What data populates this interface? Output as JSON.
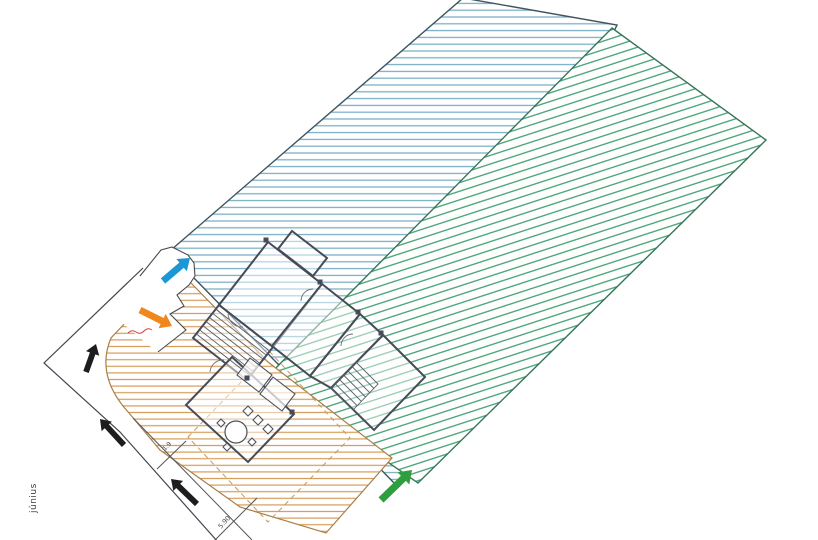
{
  "document": {
    "kind": "scanned architectural site / floor plan with colored zoning hatches",
    "background": "#ffffff"
  },
  "colors": {
    "blue_hatch": "#78aec6",
    "green_hatch": "#44a172",
    "orange_hatch": "#d59c58",
    "blue_edge": "#3e5560",
    "green_edge": "#35755a",
    "orange_edge": "#a97f47",
    "boundary_line": "#4a4a4a",
    "wall_line": "#454b57",
    "blue_arrow": "#1b97d6",
    "orange_arrow": "#f0861c",
    "green_arrow": "#2f9e3f",
    "black_arrow": "#1d1d1d",
    "red_mark": "#d04038"
  },
  "regions": {
    "blue_zone": {
      "points": "171,250 463,-2 617,25 398,487 194,278",
      "hatch": "horizontal"
    },
    "green_zone": {
      "points": "612,28 766,140 418,483 266,378",
      "hatch": "diagonal-up-right"
    },
    "orange_zone": {
      "path": "M191,283 L268,362 L392,458 L326,533 L240,507 L160,450 L129,413 Q95,376 111,338 L163,283 Z",
      "hatch": "horizontal"
    },
    "white_notch": {
      "points": "140,277 160,251 171,247 188,255 194,263 195,277 189,286 177,295 184,306 170,314 186,330 158,353 112,314"
    }
  },
  "lines": {
    "outer_site_boundary": "143,268 44,363 120,432 218,542",
    "notch_outline": "140,276 161,250 172,247 188,255 194,263 195,276 189,285 177,295 184,306 170,314 186,330 158,352",
    "curb_line": "M133,418 L252,540",
    "tick_small": "M157,469 L186,441",
    "tick_large": "M214,541 L257,498",
    "roof_overhang_dashed": "M188,437 L270,352 L350,438 L268,522 Z"
  },
  "annotations": {
    "margin_label": "június",
    "dim_small": "1.9",
    "dim_large": "5.90"
  },
  "arrows": [
    {
      "name": "blue-arrow",
      "x1": 163,
      "y1": 281,
      "x2": 190,
      "y2": 258,
      "color": "#1b97d6",
      "shaft": 3.4,
      "headL": 11,
      "headW": 8
    },
    {
      "name": "orange-arrow",
      "x1": 140,
      "y1": 310,
      "x2": 172,
      "y2": 326,
      "color": "#f0861c",
      "shaft": 3.4,
      "headL": 11,
      "headW": 8
    },
    {
      "name": "black-arrow-1",
      "x1": 86,
      "y1": 372,
      "x2": 96,
      "y2": 344,
      "color": "#1d1d1d",
      "shaft": 2.9,
      "headL": 10,
      "headW": 7
    },
    {
      "name": "black-arrow-2",
      "x1": 124,
      "y1": 445,
      "x2": 100,
      "y2": 419,
      "color": "#1d1d1d",
      "shaft": 2.9,
      "headL": 10,
      "headW": 7
    },
    {
      "name": "black-arrow-3",
      "x1": 197,
      "y1": 504,
      "x2": 171,
      "y2": 479,
      "color": "#1d1d1d",
      "shaft": 2.9,
      "headL": 10,
      "headW": 7
    },
    {
      "name": "green-arrow",
      "x1": 381,
      "y1": 500,
      "x2": 412,
      "y2": 470,
      "color": "#2f9e3f",
      "shaft": 3.6,
      "headL": 12,
      "headW": 8.5
    }
  ],
  "building": {
    "rooms": [
      "268,242 322,284 273,347 219,305",
      "292,231 327,258 313,276 278,249",
      "219,305 273,347 247,380 193,338",
      "322,284 360,314 310,376 272,346",
      "360,314 383,335 331,388 310,376",
      "383,335 425,377 374,430 331,388",
      "232,357 294,414 248,462 186,405"
    ],
    "stairA_treads": [
      "215.8,309.1 269.8,351.1",
      "212.5,313.3 266.5,355.3",
      "209.3,317.4 263.3,359.4",
      "206,321.5 260,363.5",
      "202.8,325.6 256.8,367.6",
      "199.5,329.8 253.5,371.8",
      "196.3,333.9 250.3,375.9"
    ],
    "stairB_box": "331,388 356,362 378,384 353,410",
    "stairB_treads": [
      "335.2,383.7 357.2,405.7",
      "339.3,379.3 361.3,401.3",
      "343.5,375 365.5,397",
      "347.7,370.7 369.7,392.7",
      "351.8,366.3 373.8,388.3"
    ],
    "fixtures": [
      "250,358 272,375 259,392 237,375",
      "273,377 295,394 282,411 260,394",
      "248,406 253,411 248,416 243,411",
      "258,415 263,420 258,425 253,420",
      "268,424 273,429 268,434 263,429"
    ],
    "chairs": [
      "221,419 225,423 221,427 217,423",
      "227,443 231,447 227,451 223,447",
      "252,438 256,442 252,446 248,442"
    ],
    "table": {
      "cx": 236,
      "cy": 432,
      "r": 11
    },
    "door_arcs": [
      "M243,327 A14,14 0 0 1 228,314",
      "M210,372 A13,13 0 0 1 224,360",
      "M341,346 A12,12 0 0 1 353,334",
      "M301,301 A12,12 0 0 1 313,289"
    ],
    "stubs": [
      [
        320,
        282
      ],
      [
        381,
        333
      ],
      [
        358,
        312
      ],
      [
        292,
        412
      ],
      [
        266,
        240
      ],
      [
        247,
        378
      ]
    ]
  }
}
